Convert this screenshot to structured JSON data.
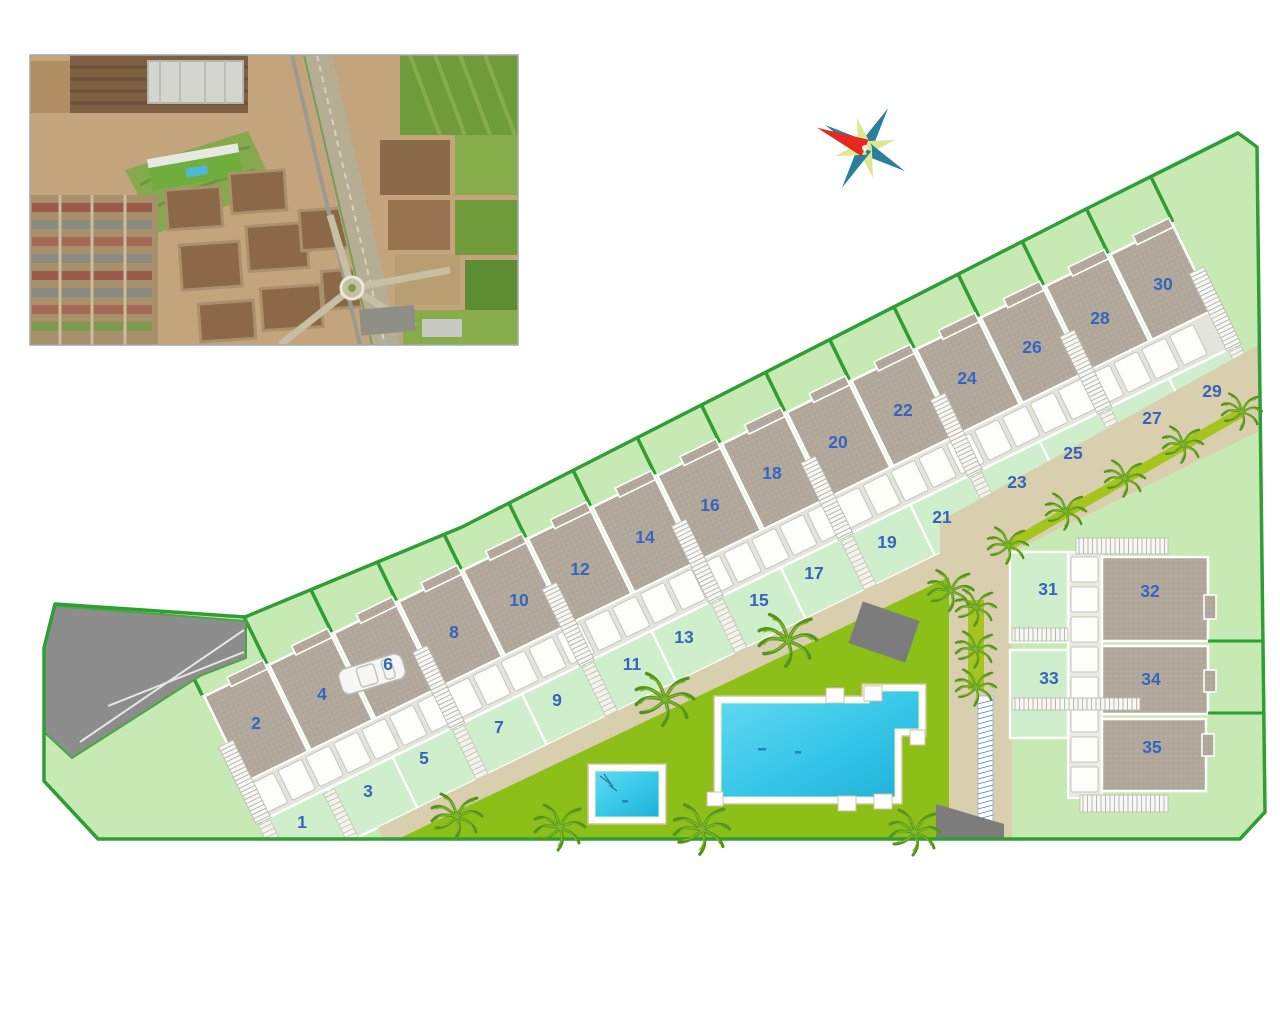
{
  "title": "residential development site plan",
  "colors": {
    "boundary_green": "#2f9e35",
    "site_fill": "#c7eab4",
    "front_garden_fill": "#cfeecb",
    "roof_gray": "#b1a89b",
    "road_tan": "#d9cfae",
    "lawn_green": "#8cbf17",
    "pool_cyan": "#35c6e8",
    "plot_number_blue": "#3565bd",
    "compass_red": "#e8281e",
    "compass_teal": "#2a7f9f",
    "compass_pale": "#dce98f"
  },
  "site_plan": {
    "plots": [
      {
        "label": "1",
        "x": 302,
        "y": 828,
        "on": "garden"
      },
      {
        "label": "2",
        "x": 256,
        "y": 729,
        "on": "roof"
      },
      {
        "label": "3",
        "x": 368,
        "y": 797,
        "on": "garden"
      },
      {
        "label": "4",
        "x": 322,
        "y": 700,
        "on": "roof"
      },
      {
        "label": "5",
        "x": 424,
        "y": 764,
        "on": "garden"
      },
      {
        "label": "6",
        "x": 388,
        "y": 670,
        "on": "roof"
      },
      {
        "label": "7",
        "x": 499,
        "y": 733,
        "on": "garden"
      },
      {
        "label": "8",
        "x": 454,
        "y": 638,
        "on": "roof"
      },
      {
        "label": "9",
        "x": 557,
        "y": 706,
        "on": "garden"
      },
      {
        "label": "10",
        "x": 519,
        "y": 606,
        "on": "roof"
      },
      {
        "label": "11",
        "x": 632,
        "y": 670,
        "on": "garden"
      },
      {
        "label": "12",
        "x": 580,
        "y": 575,
        "on": "roof"
      },
      {
        "label": "13",
        "x": 684,
        "y": 643,
        "on": "garden"
      },
      {
        "label": "14",
        "x": 645,
        "y": 543,
        "on": "roof"
      },
      {
        "label": "15",
        "x": 759,
        "y": 606,
        "on": "garden"
      },
      {
        "label": "16",
        "x": 710,
        "y": 511,
        "on": "roof"
      },
      {
        "label": "17",
        "x": 814,
        "y": 579,
        "on": "garden"
      },
      {
        "label": "18",
        "x": 772,
        "y": 479,
        "on": "roof"
      },
      {
        "label": "19",
        "x": 887,
        "y": 548,
        "on": "garden"
      },
      {
        "label": "20",
        "x": 838,
        "y": 448,
        "on": "roof"
      },
      {
        "label": "21",
        "x": 942,
        "y": 523,
        "on": "garden"
      },
      {
        "label": "22",
        "x": 903,
        "y": 416,
        "on": "roof"
      },
      {
        "label": "23",
        "x": 1017,
        "y": 488,
        "on": "garden"
      },
      {
        "label": "24",
        "x": 967,
        "y": 384,
        "on": "roof"
      },
      {
        "label": "25",
        "x": 1073,
        "y": 459,
        "on": "garden"
      },
      {
        "label": "26",
        "x": 1032,
        "y": 353,
        "on": "roof"
      },
      {
        "label": "27",
        "x": 1152,
        "y": 424,
        "on": "garden"
      },
      {
        "label": "28",
        "x": 1100,
        "y": 324,
        "on": "roof"
      },
      {
        "label": "29",
        "x": 1212,
        "y": 397,
        "on": "garden"
      },
      {
        "label": "30",
        "x": 1163,
        "y": 290,
        "on": "roof"
      },
      {
        "label": "31",
        "x": 1048,
        "y": 595,
        "on": "garden"
      },
      {
        "label": "32",
        "x": 1150,
        "y": 597,
        "on": "roof"
      },
      {
        "label": "33",
        "x": 1049,
        "y": 684,
        "on": "garden"
      },
      {
        "label": "34",
        "x": 1151,
        "y": 685,
        "on": "roof"
      },
      {
        "label": "35",
        "x": 1152,
        "y": 753,
        "on": "roof"
      }
    ]
  }
}
